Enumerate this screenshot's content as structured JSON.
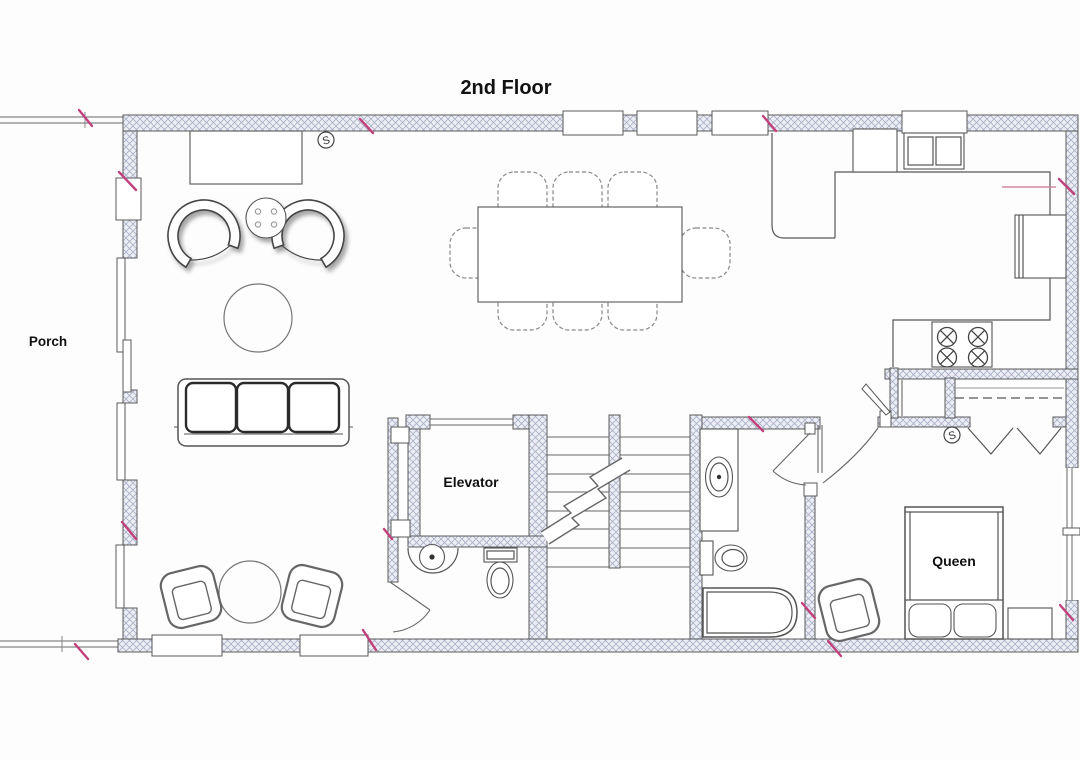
{
  "page": {
    "title": "2nd Floor"
  },
  "rooms": {
    "porch": "Porch",
    "elevator": "Elevator"
  },
  "furniture": {
    "bed_label": "Queen"
  },
  "symbols": {
    "smoke_detector": "S"
  },
  "colors": {
    "accent_pink": "#c2417c",
    "wall_line": "#5a5a5a",
    "hatch_line": "#aab0c6",
    "hatch_fill": "#edeef5",
    "furniture_line": "#555555",
    "label_text": "#111111"
  }
}
